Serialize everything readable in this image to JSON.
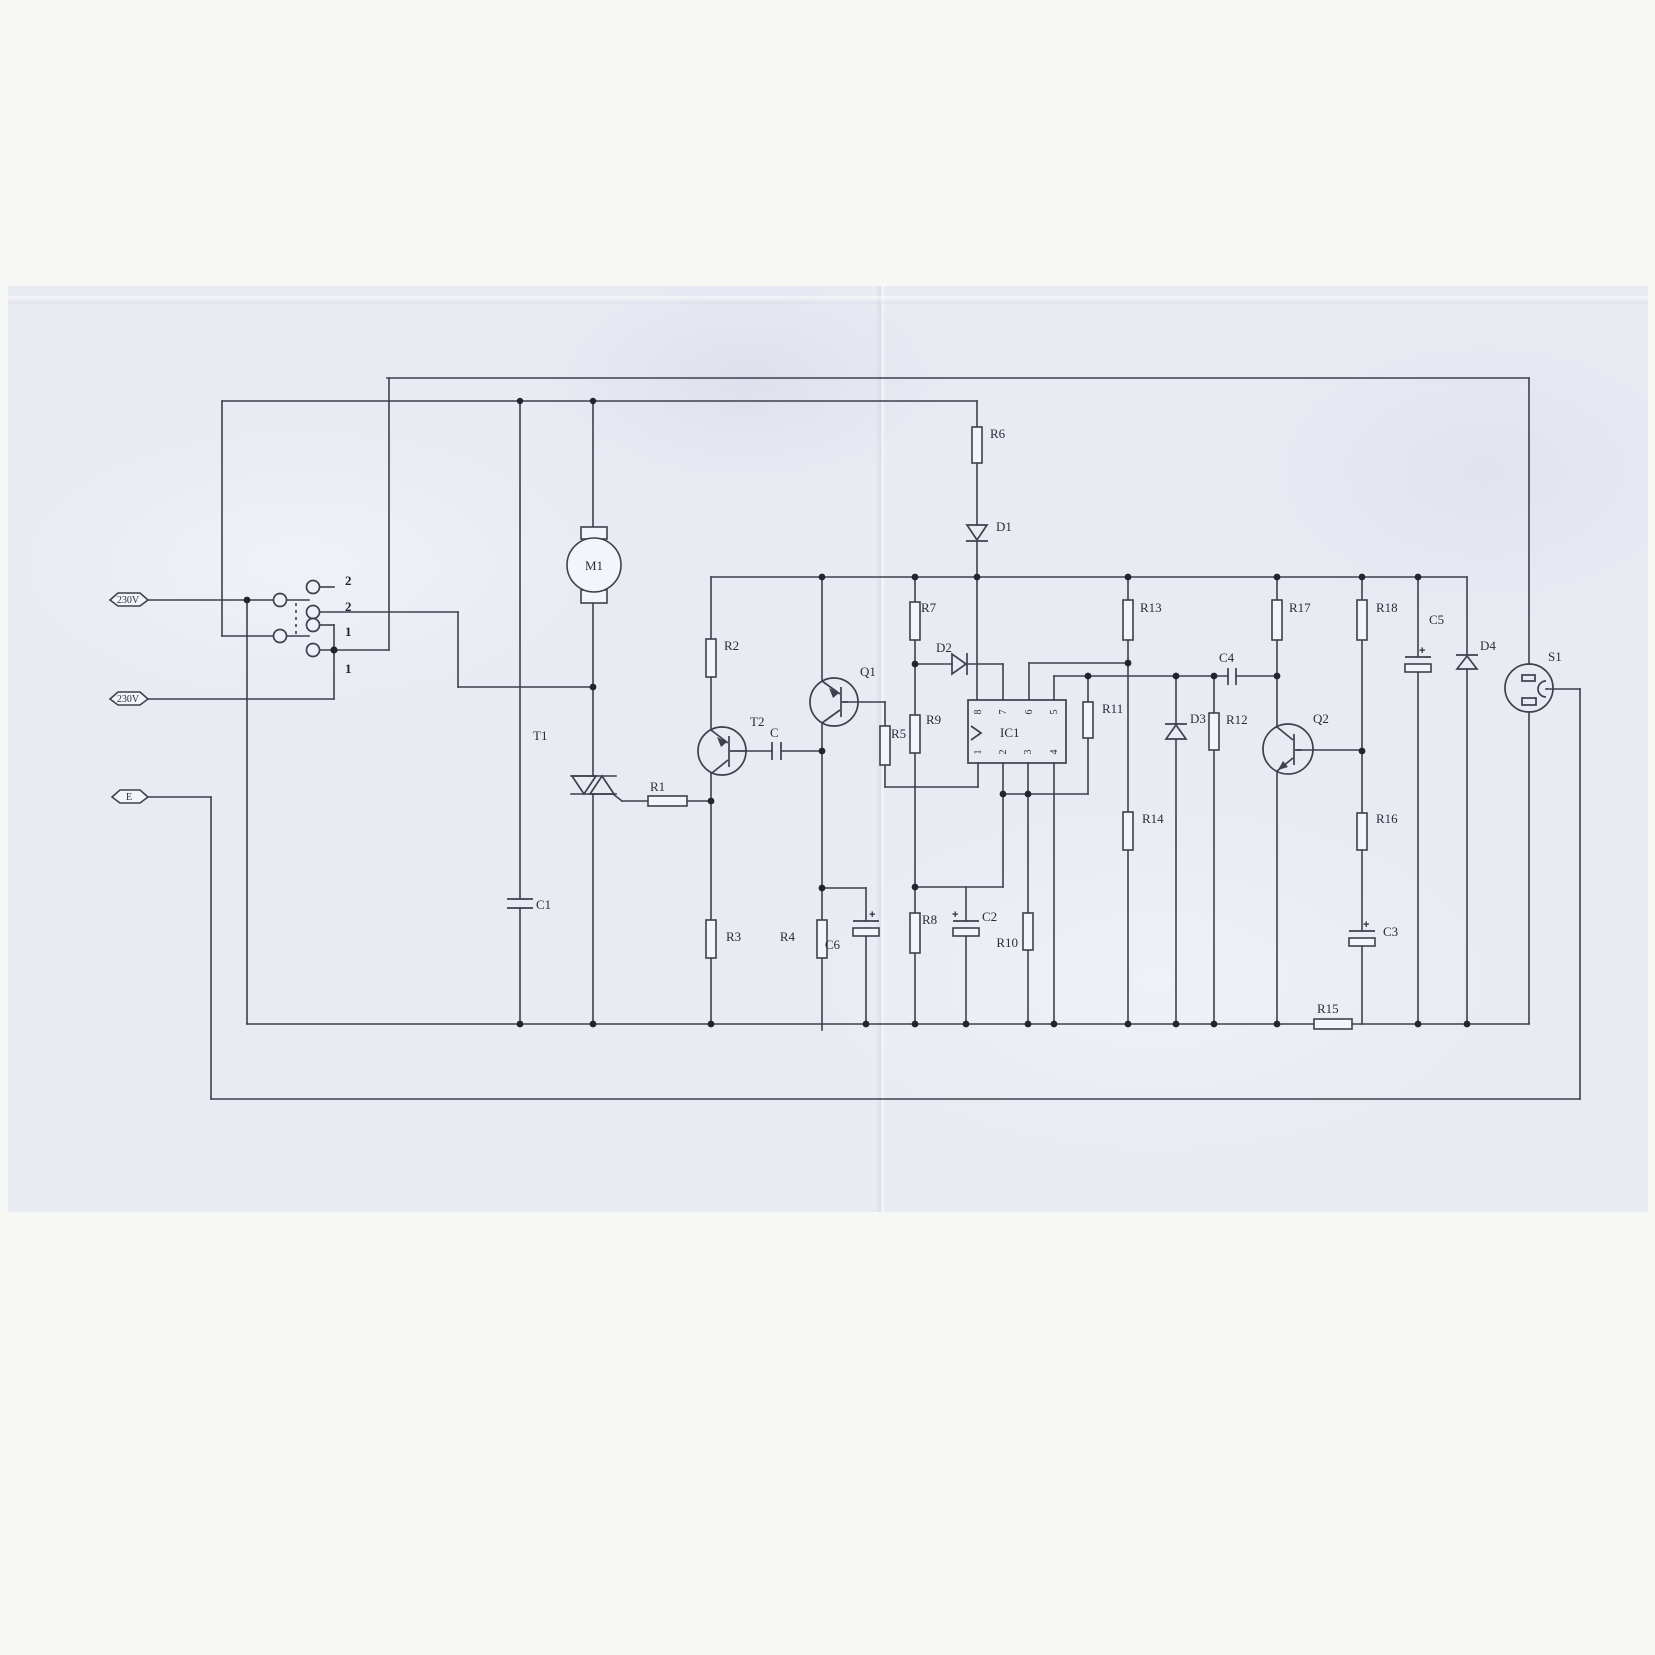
{
  "terminals": {
    "live": "230V",
    "neutral": "230V",
    "earth": "E"
  },
  "switch": {
    "positions": [
      "2",
      "2",
      "1",
      "1"
    ]
  },
  "ic": {
    "name": "IC1",
    "pins_top": [
      "8",
      "7",
      "6",
      "5"
    ],
    "pins_bottom": [
      "1",
      "2",
      "3",
      "4"
    ]
  },
  "components": {
    "motor": "M1",
    "triac": "T1",
    "transistors": [
      "T2",
      "Q1",
      "Q2"
    ],
    "socket": "S1",
    "resistors": [
      "R1",
      "R2",
      "R3",
      "R4",
      "R5",
      "R6",
      "R7",
      "R8",
      "R9",
      "R10",
      "R11",
      "R12",
      "R13",
      "R14",
      "R15",
      "R16",
      "R17",
      "R18"
    ],
    "capacitors": [
      "C",
      "C1",
      "C2",
      "C3",
      "C4",
      "C5",
      "C6"
    ],
    "diodes": [
      "D1",
      "D2",
      "D3",
      "D4"
    ]
  },
  "symbols": {
    "plus": "+"
  }
}
